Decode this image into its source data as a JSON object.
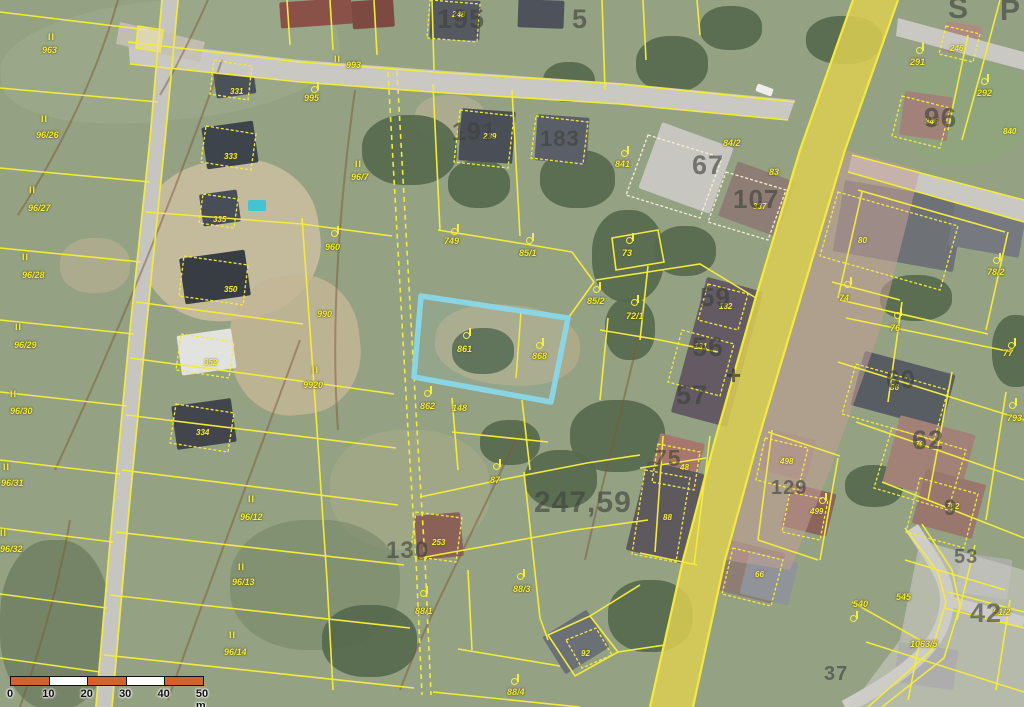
{
  "map": {
    "type": "cadastral-aerial-view",
    "parcel_line_color": "#f3ea3e",
    "highlighted_parcel": {
      "numbers": [
        "861",
        "868"
      ],
      "outline_color": "#8ad8e9"
    },
    "labels": {
      "parcel": [
        {
          "t": "963",
          "x": 42,
          "y": 46
        },
        {
          "t": "96/26",
          "x": 36,
          "y": 131
        },
        {
          "t": "96/27",
          "x": 28,
          "y": 204
        },
        {
          "t": "96/28",
          "x": 22,
          "y": 271
        },
        {
          "t": "96/29",
          "x": 14,
          "y": 341
        },
        {
          "t": "96/30",
          "x": 10,
          "y": 407
        },
        {
          "t": "96/31",
          "x": 1,
          "y": 479
        },
        {
          "t": "96/32",
          "x": 0,
          "y": 545
        },
        {
          "t": "96/12",
          "x": 240,
          "y": 513
        },
        {
          "t": "96/13",
          "x": 232,
          "y": 578
        },
        {
          "t": "96/14",
          "x": 224,
          "y": 648
        },
        {
          "t": "993",
          "x": 346,
          "y": 61
        },
        {
          "t": "995",
          "x": 304,
          "y": 94
        },
        {
          "t": "96/7",
          "x": 351,
          "y": 173
        },
        {
          "t": "960",
          "x": 325,
          "y": 243
        },
        {
          "t": "990",
          "x": 317,
          "y": 310
        },
        {
          "t": "9920",
          "x": 303,
          "y": 381
        },
        {
          "t": "749",
          "x": 444,
          "y": 237
        },
        {
          "t": "85/1",
          "x": 519,
          "y": 249
        },
        {
          "t": "85/2",
          "x": 587,
          "y": 297
        },
        {
          "t": "861",
          "x": 457,
          "y": 345
        },
        {
          "t": "868",
          "x": 532,
          "y": 352
        },
        {
          "t": "862",
          "x": 420,
          "y": 402
        },
        {
          "t": "148",
          "x": 452,
          "y": 404
        },
        {
          "t": "87",
          "x": 490,
          "y": 476
        },
        {
          "t": "88/1",
          "x": 415,
          "y": 607
        },
        {
          "t": "88/3",
          "x": 513,
          "y": 585
        },
        {
          "t": "88/4",
          "x": 507,
          "y": 688
        },
        {
          "t": "841",
          "x": 615,
          "y": 160
        },
        {
          "t": "84/2",
          "x": 723,
          "y": 139
        },
        {
          "t": "83",
          "x": 769,
          "y": 168
        },
        {
          "t": "73",
          "x": 622,
          "y": 249
        },
        {
          "t": "72/1",
          "x": 626,
          "y": 312
        },
        {
          "t": "74",
          "x": 839,
          "y": 294
        },
        {
          "t": "76",
          "x": 890,
          "y": 324
        },
        {
          "t": "78/2",
          "x": 987,
          "y": 268
        },
        {
          "t": "77",
          "x": 1003,
          "y": 349
        },
        {
          "t": "793",
          "x": 1007,
          "y": 414
        },
        {
          "t": "291",
          "x": 910,
          "y": 58
        },
        {
          "t": "292",
          "x": 977,
          "y": 89
        },
        {
          "t": "540",
          "x": 853,
          "y": 600
        },
        {
          "t": "545",
          "x": 896,
          "y": 593
        },
        {
          "t": "1063/5",
          "x": 910,
          "y": 640
        },
        {
          "t": "51/2",
          "x": 993,
          "y": 608
        }
      ],
      "building": [
        {
          "t": "331",
          "x": 230,
          "y": 88
        },
        {
          "t": "333",
          "x": 224,
          "y": 153
        },
        {
          "t": "335",
          "x": 213,
          "y": 216
        },
        {
          "t": "350",
          "x": 224,
          "y": 286
        },
        {
          "t": "352",
          "x": 204,
          "y": 359
        },
        {
          "t": "334",
          "x": 196,
          "y": 429
        },
        {
          "t": "248",
          "x": 452,
          "y": 11
        },
        {
          "t": "239",
          "x": 483,
          "y": 133
        },
        {
          "t": "337",
          "x": 753,
          "y": 203
        },
        {
          "t": "132",
          "x": 719,
          "y": 303
        },
        {
          "t": "131",
          "x": 694,
          "y": 343
        },
        {
          "t": "80",
          "x": 858,
          "y": 237
        },
        {
          "t": "86",
          "x": 890,
          "y": 384
        },
        {
          "t": "79",
          "x": 915,
          "y": 441
        },
        {
          "t": "782",
          "x": 946,
          "y": 503
        },
        {
          "t": "48",
          "x": 680,
          "y": 464
        },
        {
          "t": "88",
          "x": 663,
          "y": 514
        },
        {
          "t": "498",
          "x": 780,
          "y": 458
        },
        {
          "t": "499",
          "x": 810,
          "y": 508
        },
        {
          "t": "66",
          "x": 755,
          "y": 571
        },
        {
          "t": "92",
          "x": 581,
          "y": 650
        },
        {
          "t": "253",
          "x": 432,
          "y": 539
        },
        {
          "t": "346",
          "x": 925,
          "y": 118
        },
        {
          "t": "246",
          "x": 950,
          "y": 45
        },
        {
          "t": "840",
          "x": 1003,
          "y": 128
        }
      ],
      "background": [
        {
          "t": "195",
          "x": 437,
          "y": 6,
          "s": 27
        },
        {
          "t": "5",
          "x": 572,
          "y": 6,
          "s": 27
        },
        {
          "t": "183",
          "x": 540,
          "y": 128,
          "s": 22
        },
        {
          "t": "191",
          "x": 452,
          "y": 120,
          "s": 25
        },
        {
          "t": "67",
          "x": 692,
          "y": 152,
          "s": 27
        },
        {
          "t": "107",
          "x": 733,
          "y": 186,
          "s": 26
        },
        {
          "t": "96",
          "x": 924,
          "y": 104,
          "s": 28
        },
        {
          "t": "59",
          "x": 700,
          "y": 284,
          "s": 26
        },
        {
          "t": "56",
          "x": 692,
          "y": 334,
          "s": 27
        },
        {
          "t": "57",
          "x": 676,
          "y": 382,
          "s": 27
        },
        {
          "t": "69",
          "x": 886,
          "y": 368,
          "s": 25
        },
        {
          "t": "62",
          "x": 912,
          "y": 427,
          "s": 27
        },
        {
          "t": "9",
          "x": 944,
          "y": 497,
          "s": 22
        },
        {
          "t": "75",
          "x": 654,
          "y": 447,
          "s": 23
        },
        {
          "t": "129",
          "x": 771,
          "y": 478,
          "s": 20
        },
        {
          "t": "247,59",
          "x": 534,
          "y": 488,
          "s": 30
        },
        {
          "t": "42",
          "x": 970,
          "y": 600,
          "s": 27
        },
        {
          "t": "53",
          "x": 954,
          "y": 547,
          "s": 20
        },
        {
          "t": "37",
          "x": 824,
          "y": 664,
          "s": 20
        },
        {
          "t": "130",
          "x": 386,
          "y": 539,
          "s": 24
        },
        {
          "t": "S",
          "x": 948,
          "y": -6,
          "s": 30
        },
        {
          "t": "P",
          "x": 1000,
          "y": -4,
          "s": 30
        }
      ],
      "cross": [
        {
          "t": "+",
          "x": 726,
          "y": 362,
          "s": 26
        }
      ],
      "landuse_ii": [
        {
          "x": 48,
          "y": 33
        },
        {
          "x": 41,
          "y": 115
        },
        {
          "x": 29,
          "y": 186
        },
        {
          "x": 22,
          "y": 253
        },
        {
          "x": 15,
          "y": 323
        },
        {
          "x": 10,
          "y": 390
        },
        {
          "x": 3,
          "y": 463
        },
        {
          "x": 0,
          "y": 529
        },
        {
          "x": 248,
          "y": 495
        },
        {
          "x": 238,
          "y": 563
        },
        {
          "x": 229,
          "y": 631
        },
        {
          "x": 334,
          "y": 55
        },
        {
          "x": 355,
          "y": 160
        },
        {
          "x": 312,
          "y": 366
        }
      ],
      "landuse_hook": [
        {
          "x": 331,
          "y": 226
        },
        {
          "x": 311,
          "y": 82
        },
        {
          "x": 451,
          "y": 224
        },
        {
          "x": 526,
          "y": 233
        },
        {
          "x": 593,
          "y": 282
        },
        {
          "x": 463,
          "y": 328
        },
        {
          "x": 536,
          "y": 338
        },
        {
          "x": 424,
          "y": 386
        },
        {
          "x": 493,
          "y": 459
        },
        {
          "x": 517,
          "y": 569
        },
        {
          "x": 511,
          "y": 674
        },
        {
          "x": 420,
          "y": 586
        },
        {
          "x": 621,
          "y": 146
        },
        {
          "x": 626,
          "y": 233
        },
        {
          "x": 631,
          "y": 295
        },
        {
          "x": 916,
          "y": 43
        },
        {
          "x": 981,
          "y": 74
        },
        {
          "x": 844,
          "y": 277
        },
        {
          "x": 894,
          "y": 308
        },
        {
          "x": 993,
          "y": 253
        },
        {
          "x": 1008,
          "y": 338
        },
        {
          "x": 1009,
          "y": 398
        },
        {
          "x": 819,
          "y": 493
        },
        {
          "x": 850,
          "y": 611
        }
      ]
    }
  },
  "scalebar": {
    "unit_labels": [
      "0",
      "10",
      "20",
      "30",
      "40",
      "50 m"
    ],
    "segments": 5,
    "segment_color_a": "#d2622e",
    "segment_color_b": "#ffffff",
    "length_m": 50
  }
}
